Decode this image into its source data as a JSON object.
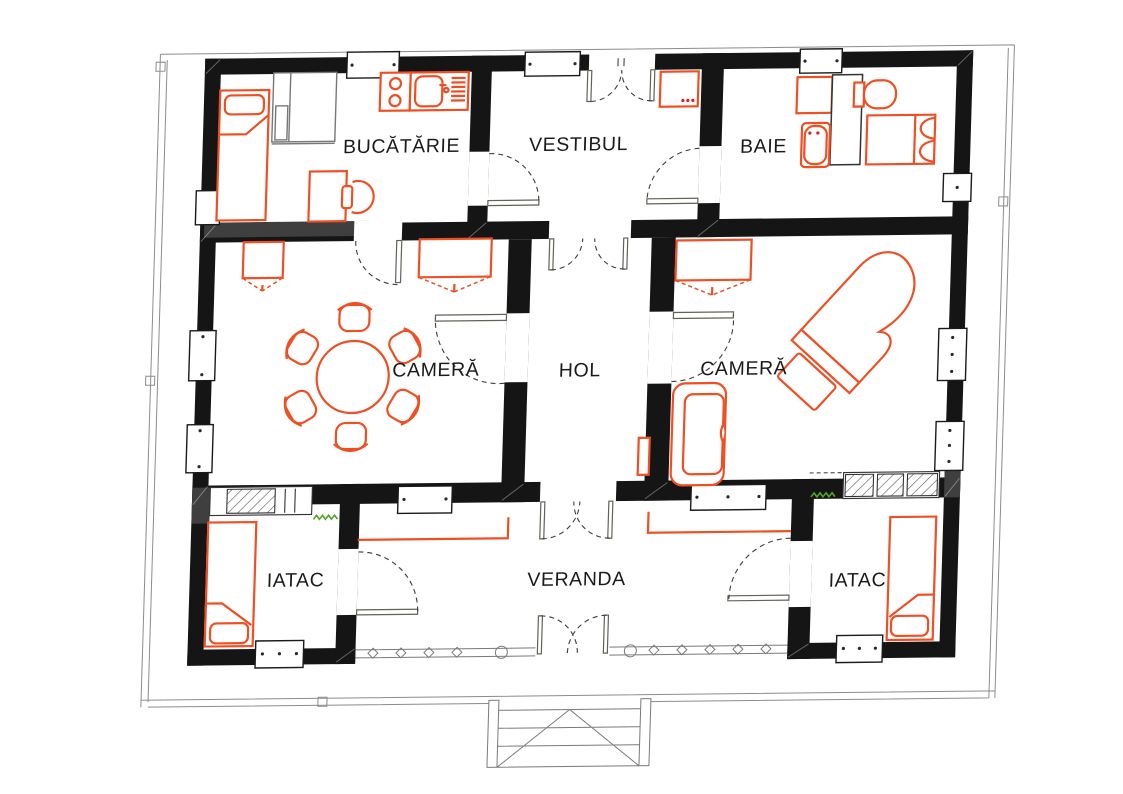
{
  "page": {
    "background_color": "#ffffff",
    "drawing_type": "house floor plan"
  },
  "plan": {
    "language": "Romanian",
    "colors": {
      "wall": "#151515",
      "furniture_outline": "#f04e23",
      "label_text": "#1a1a1a",
      "boundary_line": "#8c8c8c",
      "door_leaf": "#5f6457",
      "vegetation_green": "#55a427",
      "gray_fill": "#3f3f3f"
    },
    "rooms": [
      {
        "id": "bucatarie",
        "label": "BUCĂTĂRIE"
      },
      {
        "id": "vestibul",
        "label": "VESTIBUL"
      },
      {
        "id": "baie",
        "label": "BAIE"
      },
      {
        "id": "camera-left",
        "label": "CAMERĂ"
      },
      {
        "id": "hol",
        "label": "HOL"
      },
      {
        "id": "camera-right",
        "label": "CAMERĂ"
      },
      {
        "id": "iatac-left",
        "label": "IATAC"
      },
      {
        "id": "veranda",
        "label": "VERANDA"
      },
      {
        "id": "iatac-right",
        "label": "IATAC"
      }
    ],
    "furniture": [
      {
        "room": "bucatarie",
        "items": [
          "single-bed",
          "wardrobe-cabinet",
          "desk",
          "chair",
          "cooktop-two-burners",
          "kitchen-sink-with-drainboard"
        ]
      },
      {
        "room": "vestibul",
        "items": [
          "washing-machine",
          "double-entrance-door"
        ]
      },
      {
        "room": "baie",
        "items": [
          "shower-tray",
          "bathtub",
          "toilet",
          "partition",
          "bench-bed"
        ]
      },
      {
        "room": "camera-left",
        "items": [
          "round-dining-table",
          "six-chairs",
          "small-wardrobe",
          "wide-wardrobe"
        ]
      },
      {
        "room": "camera-right",
        "items": [
          "grand-piano",
          "piano-bench",
          "sofa",
          "side-table",
          "wardrobe"
        ]
      },
      {
        "room": "iatac-left",
        "items": [
          "single-bed",
          "masonry-stove"
        ]
      },
      {
        "room": "iatac-right",
        "items": [
          "single-bed",
          "masonry-stove"
        ]
      },
      {
        "room": "veranda",
        "items": [
          "wall-benches",
          "balustrade-railing",
          "entrance-steps"
        ]
      }
    ]
  }
}
